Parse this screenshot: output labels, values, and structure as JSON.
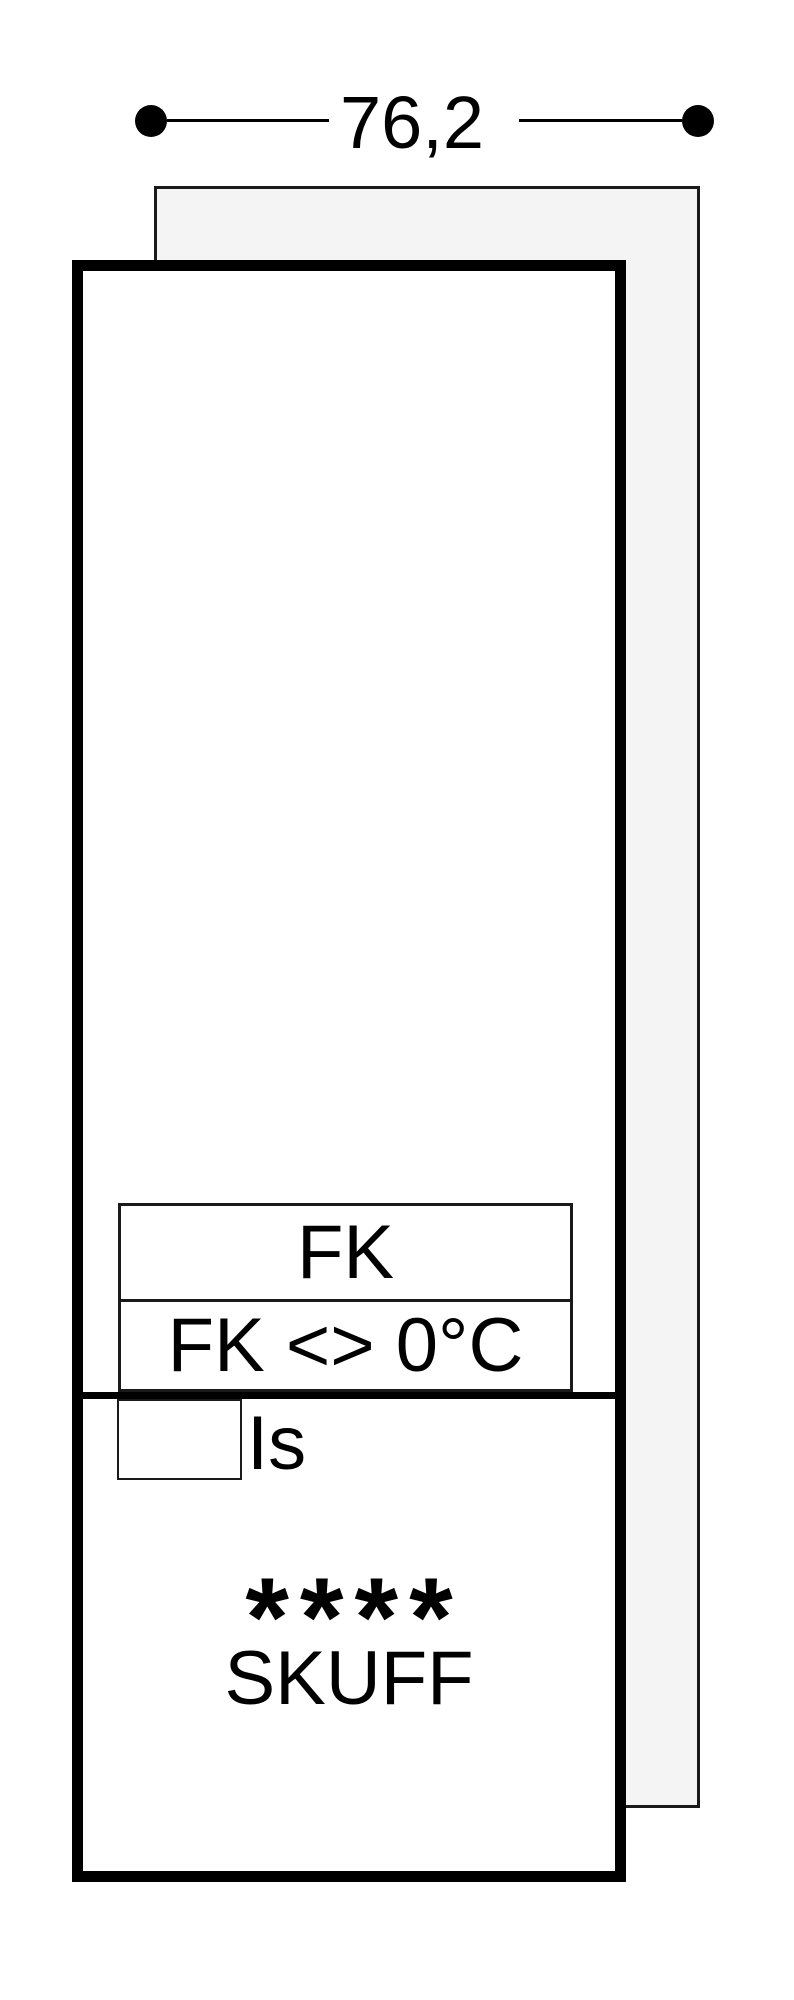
{
  "diagram": {
    "title_hint": "appliance niche installation diagram",
    "dimension_label": "76,2",
    "upper_compartment": {
      "label": "FK",
      "sub_label": "FK <> 0°C"
    },
    "lower_compartment": {
      "ice_label": "Is",
      "star_rating": "****",
      "drawer_label": "SKUFF"
    }
  },
  "colors": {
    "line": "#000000",
    "thin": "#1a1a1a",
    "panel_fill": "#f4f4f4",
    "background": "#ffffff"
  }
}
